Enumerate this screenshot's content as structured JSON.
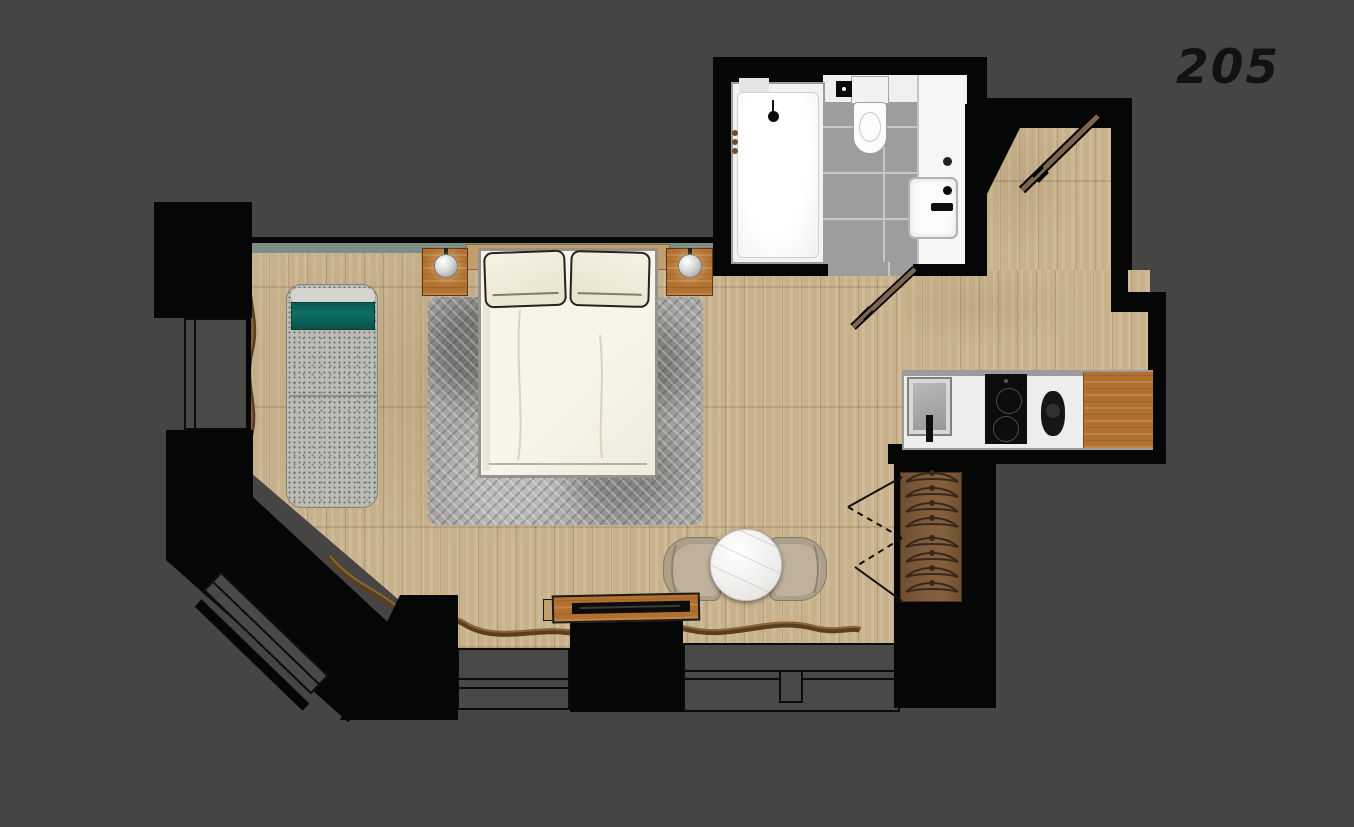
{
  "room_label": "205",
  "plan": {
    "areas": [
      "bedroom",
      "bathroom",
      "kitchenette",
      "entry",
      "wardrobe"
    ],
    "fixtures": [
      "double-bed",
      "pillows",
      "headboard",
      "nightstand-ball-lamps",
      "chaise-lounge",
      "herringbone-rug",
      "round-marble-table",
      "lounge-chairs",
      "tv-console",
      "tv",
      "kitchen-counter",
      "kitchen-sink",
      "induction-cooktop",
      "kettle",
      "cutting-board",
      "wardrobe-hangers",
      "shower-tub",
      "toilet",
      "bathroom-sink",
      "entry-door-open",
      "bathroom-door-open",
      "windows",
      "driftwood-decor"
    ]
  },
  "colors": {
    "background": "#474544",
    "walls": "#060606",
    "wood_floor": "#c8b28c",
    "rug_gray": "#a6a5a3",
    "teal_accent": "#0e6f64",
    "green_ledge": "#7d8e86",
    "furniture_wood": "#b2702f",
    "bathroom_tile": "#9d9d9d",
    "fixture_white": "#f6f6f4"
  }
}
